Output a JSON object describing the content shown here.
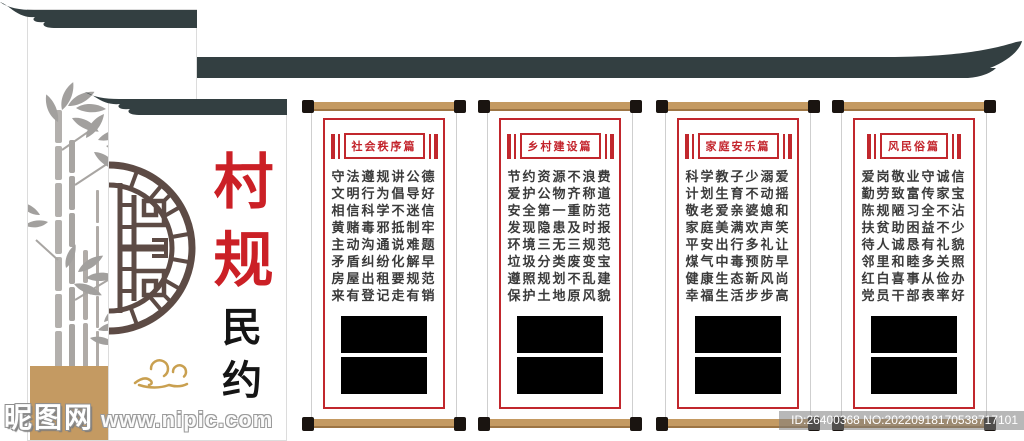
{
  "title_panel": {
    "title_main": "村规",
    "title_sub": "民约"
  },
  "scrolls": [
    {
      "title": "社会秩序篇",
      "lines": [
        "守法遵规讲公德",
        "文明行为倡导好",
        "相信科学不迷信",
        "黄赌毒邪抵制牢",
        "主动沟通说难题",
        "矛盾纠纷化解早",
        "房屋出租要规范",
        "来有登记走有销"
      ]
    },
    {
      "title": "乡村建设篇",
      "lines": [
        "节约资源不浪费",
        "爱护公物齐称道",
        "安全第一重防范",
        "发现隐患及时报",
        "环境三无三规范",
        "垃圾分类废变宝",
        "遵照规划不乱建",
        "保护土地原风貌"
      ]
    },
    {
      "title": "家庭安乐篇",
      "lines": [
        "科学教子少溺爱",
        "计划生育不动摇",
        "敬老爱亲婆媳和",
        "家庭美满欢声笑",
        "平安出行多礼让",
        "煤气中毒预防早",
        "健康生态新风尚",
        "幸福生活步步高"
      ]
    },
    {
      "title": "风民俗篇",
      "lines": [
        "爱岗敬业守诚信",
        "勤劳致富传家宝",
        "陈规陋习全不沾",
        "扶贫助困益不少",
        "待人诚恳有礼貌",
        "邻里和睦多关照",
        "红白喜事从俭办",
        "党员干部表率好"
      ]
    }
  ],
  "watermarks": {
    "site_name": "昵图网",
    "site_url": "www.nipic.com",
    "id_text": "ID:26400368 NO:20220918170538717101"
  },
  "colors": {
    "roof": "#333f41",
    "roller": "#c49a62",
    "frame_red": "#c1272d",
    "title_red": "#c3232b",
    "hanzi_red": "#cb2026",
    "gold": "#c9a050",
    "lattice": "#5d4b45",
    "ink": "#3b3b3b"
  }
}
